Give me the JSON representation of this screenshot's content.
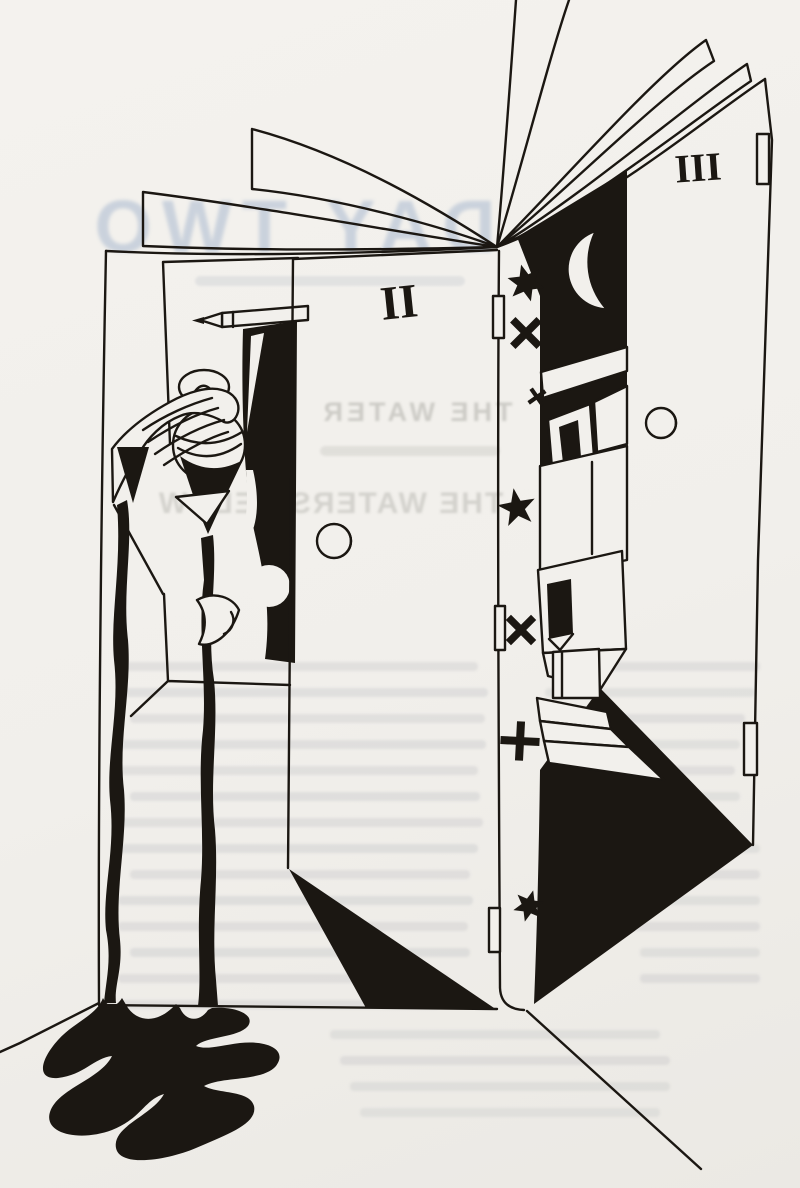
{
  "artwork": {
    "panel_numerals": {
      "middle_door": "II",
      "right_door": "III"
    },
    "showthrough_text": {
      "chapter_title": "DAY TWO",
      "heading_line_1": "THE WATER",
      "heading_line_2": "THE WATERS BELOW"
    },
    "palette": {
      "paper": "#f2f0ec",
      "ink": "#1b1712",
      "showthrough_blue": "#8ea4c4",
      "showthrough_gray": "#9a9a93"
    },
    "motifs": {
      "book": "open-book-with-fanned-pages",
      "moon": "crescent-moon",
      "stars": [
        "six-pointed-star",
        "x-cross-star",
        "small-x-star",
        "five-pointed-star",
        "x-cross-star",
        "plus-cross-star",
        "six-pointed-star"
      ],
      "left_window_scene": "hand-pouring-vessel-with-pencil-and-curtain",
      "ink_flow": "two-drip-streams-into-floor-puddle"
    }
  }
}
